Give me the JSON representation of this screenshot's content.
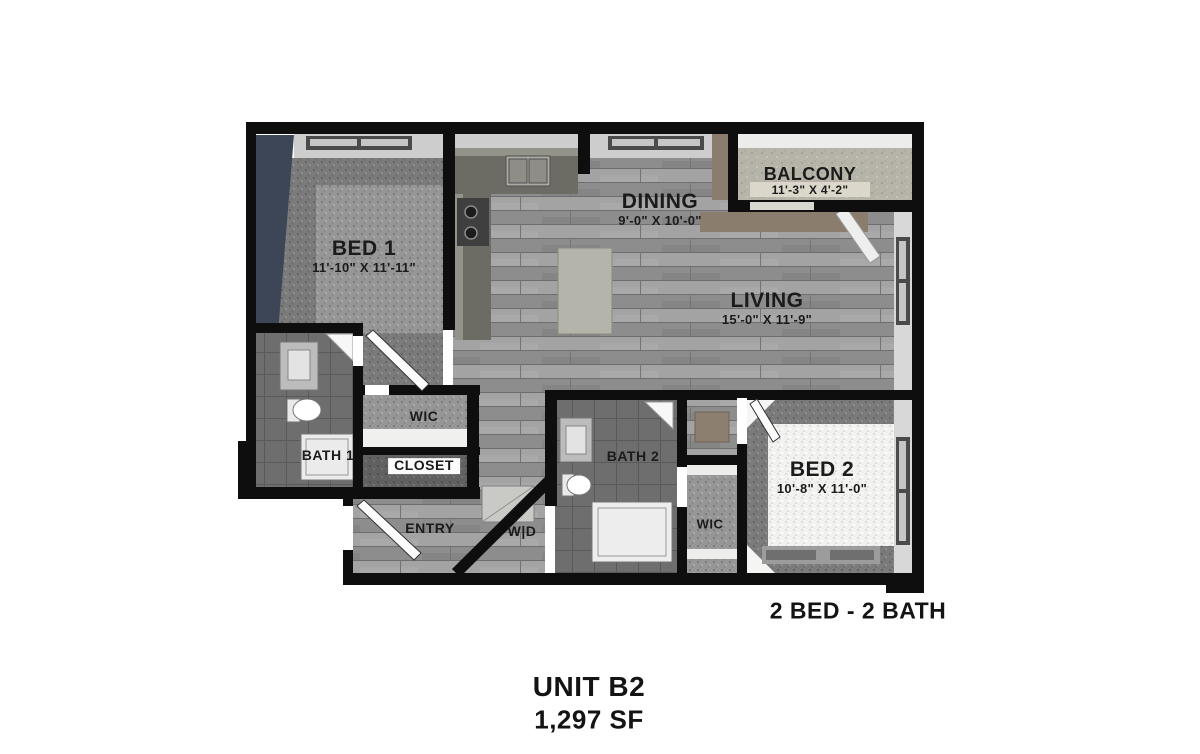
{
  "unit": {
    "name": "UNIT B2",
    "area": "1,297 SF",
    "layout": "2 BED - 2 BATH"
  },
  "rooms": {
    "bed1": {
      "name": "BED 1",
      "dims": "11'-10\" X 11'-11\""
    },
    "dining": {
      "name": "DINING",
      "dims": "9'-0\" X 10'-0\""
    },
    "balcony": {
      "name": "BALCONY",
      "dims": "11'-3\" X 4'-2\""
    },
    "living": {
      "name": "LIVING",
      "dims": "15'-0\" X 11'-9\""
    },
    "bed2": {
      "name": "BED 2",
      "dims": "10'-8\" X 11'-0\""
    },
    "bath1": {
      "name": "BATH 1"
    },
    "bath2": {
      "name": "BATH 2"
    },
    "wic1": {
      "name": "WIC"
    },
    "wic2": {
      "name": "WIC"
    },
    "closet": {
      "name": "CLOSET"
    },
    "entry": {
      "name": "ENTRY"
    },
    "washer_dryer": {
      "name": "W|D"
    }
  },
  "colors": {
    "wall": "#0e0e0e",
    "accent_wall": "#3c4657",
    "wood_floor": "#9a9a9a",
    "carpet_bed1": "#909090",
    "carpet_bed2": "#f2f2f0",
    "tile_bath": "#6e6e6e",
    "balcony_concrete": "#b6b3a9",
    "ledge_taupe": "#8b7d6e"
  }
}
